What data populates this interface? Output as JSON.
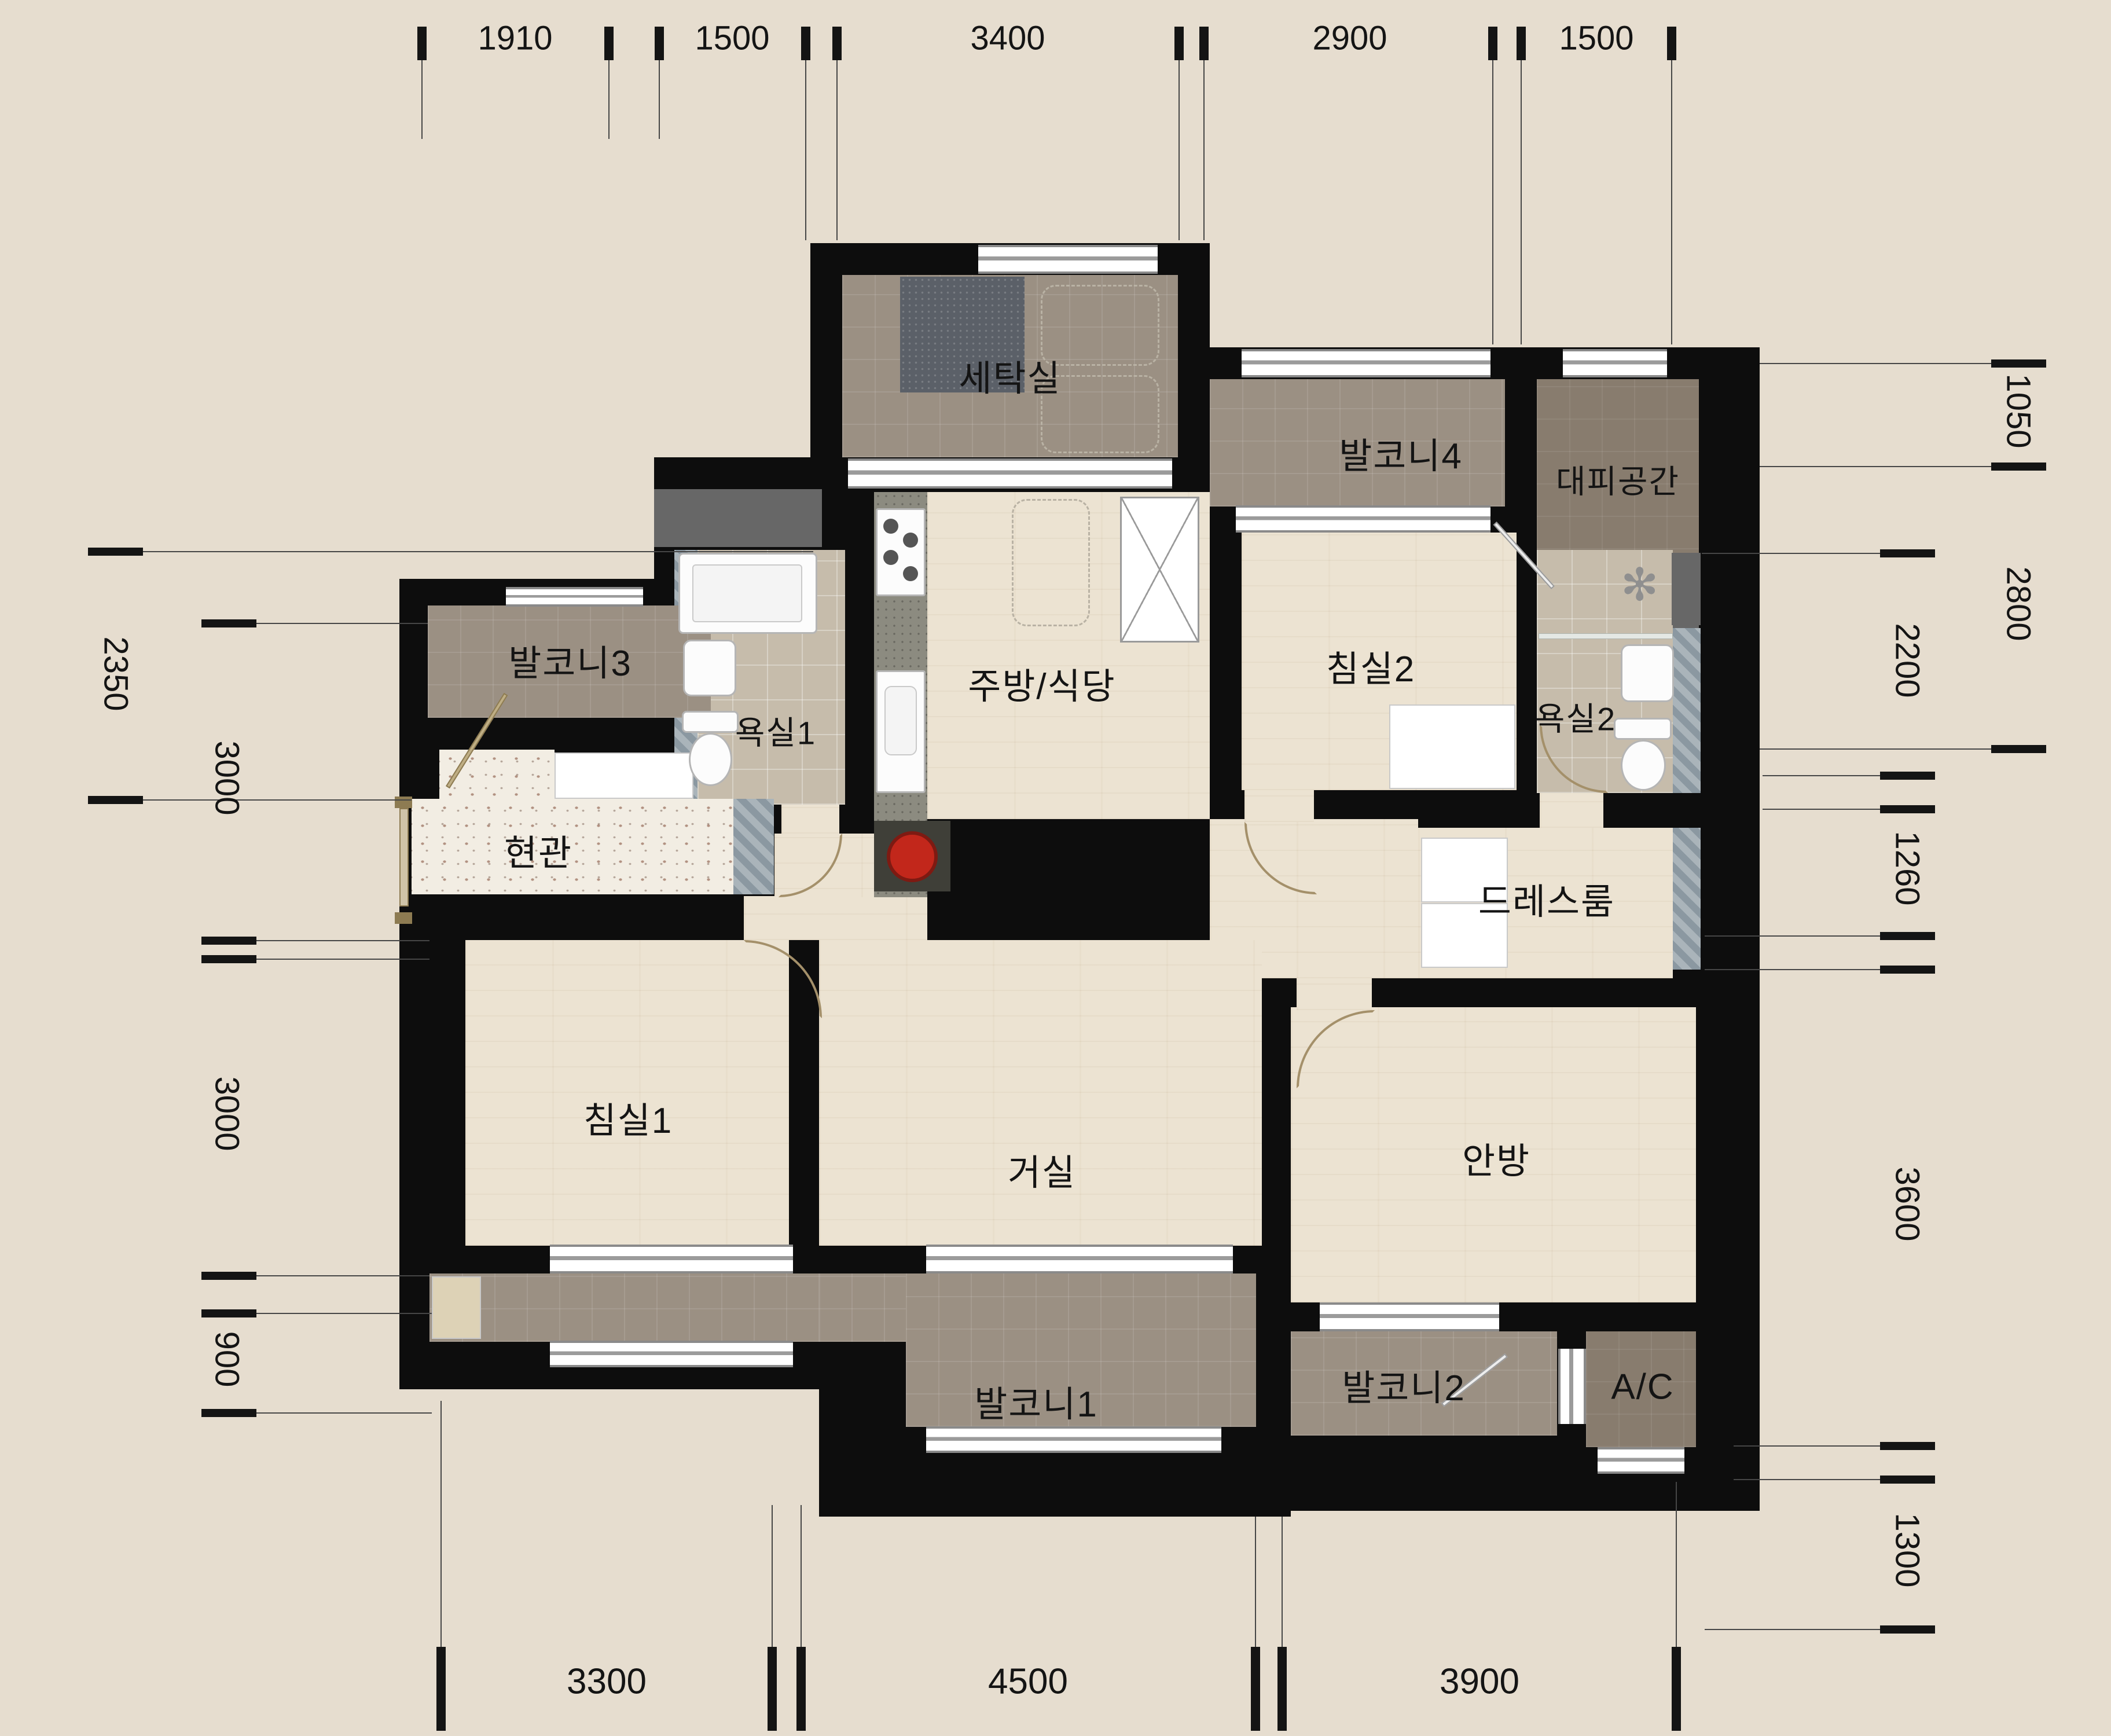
{
  "plan": {
    "type": "korean-apartment-floor-plan"
  },
  "colors": {
    "background": "#e6ddcf",
    "wall": "#0d0d0d",
    "wood_floor": "#ece3d2",
    "balcony_tile": "#9b9083",
    "dark_tile": "#887c6e",
    "bath_tile": "#c6bcab",
    "terrazzo": "#f2ede3",
    "stove_accent": "#c2271b",
    "dim_text": "#141414"
  },
  "rooms": {
    "laundry": {
      "label": "세탁실"
    },
    "balcony4": {
      "label": "발코니4"
    },
    "shelter": {
      "label": "대피공간"
    },
    "balcony3": {
      "label": "발코니3"
    },
    "bath1": {
      "label": "욕실1"
    },
    "kitchen": {
      "label": "주방/식당"
    },
    "bedroom2": {
      "label": "침실2"
    },
    "bath2": {
      "label": "욕실2"
    },
    "entrance": {
      "label": "현관"
    },
    "dressroom": {
      "label": "드레스룸"
    },
    "bedroom1": {
      "label": "침실1"
    },
    "living": {
      "label": "거실"
    },
    "master": {
      "label": "안방"
    },
    "balcony1": {
      "label": "발코니1"
    },
    "balcony2": {
      "label": "발코니2"
    },
    "ac": {
      "label": "A/C"
    }
  },
  "dimensions": {
    "top": [
      "1910",
      "1500",
      "3400",
      "2900",
      "1500"
    ],
    "left_outer": [
      "2350"
    ],
    "left_inner": [
      "3000",
      "3000",
      "900"
    ],
    "right_outer": [
      "1050",
      "2800"
    ],
    "right_inner": [
      "2200",
      "1260",
      "3600",
      "1300"
    ],
    "bottom": [
      "3300",
      "4500",
      "3900"
    ]
  }
}
